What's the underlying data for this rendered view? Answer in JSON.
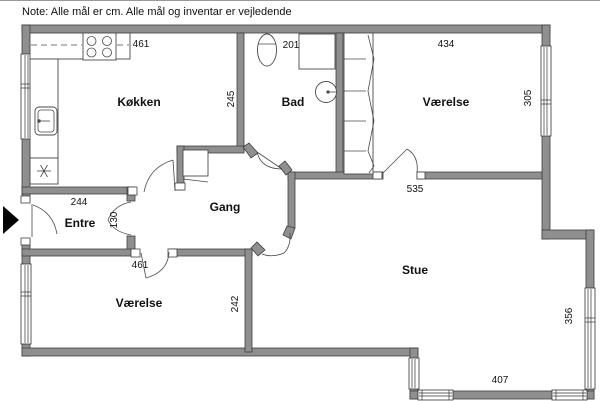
{
  "note": "Note: Alle mål er cm. Alle mål og inventar er vejledende",
  "rooms": {
    "kitchen": "Køkken",
    "bath": "Bad",
    "bedroom1": "Værelse",
    "hall": "Gang",
    "entry": "Entre",
    "living": "Stue",
    "bedroom2": "Værelse"
  },
  "measurements": {
    "kitchen_top": "461",
    "bath_top": "201",
    "bedroom1_top": "434",
    "kitchen_right": "245",
    "bedroom1_right": "305",
    "living_top": "535",
    "entry_top": "244",
    "entry_opening": "130",
    "bedroom2_top": "461",
    "bedroom2_right": "242",
    "living_right": "356",
    "living_bottom": "407"
  },
  "fixtures": [
    "stove",
    "kitchen-sink",
    "refrigerator",
    "toilet",
    "shower",
    "washbasin",
    "wardrobe",
    "cupboard"
  ],
  "colors": {
    "wall": "#8f8f8f",
    "wall_outline": "#3f3f3f",
    "entrance_marker": "#000000"
  }
}
